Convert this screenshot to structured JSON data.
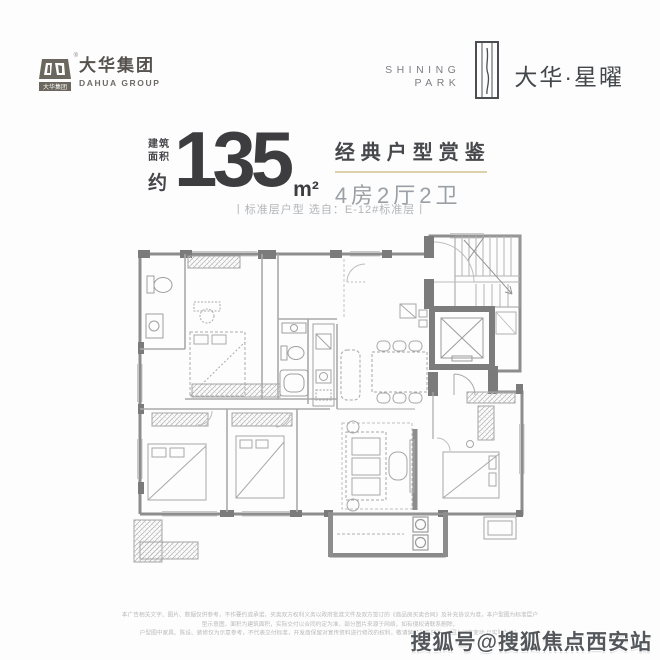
{
  "header_left": {
    "brand_cn": "大华集团",
    "brand_en": "DAHUA GROUP",
    "registered_mark": "®",
    "emblem_icon": "dahua-emblem",
    "emblem_color": "#6b675e"
  },
  "header_right": {
    "en_line1": "SHINING",
    "en_line2": "PARK",
    "tower_icon": "shining-park-tower-mark",
    "brand": "大华·星曜",
    "brand_color": "#43474b"
  },
  "title_block": {
    "area_prefix_line1": "建筑",
    "area_prefix_line2": "面积",
    "area_prefix_line3": "约",
    "area_value": "135",
    "area_unit": "m²",
    "headline": "经典户型赏鉴",
    "spec": "4房2厅2卫",
    "divider_color": "#ddd0a9",
    "caption": "丨标准层户型  选自：E-12#标准层丨"
  },
  "floorplan": {
    "type": "apartment-floor-plan-drawing",
    "features": "stair-and-elevator-core, 4 bedrooms, living-dining room with table for 6, 2 bathrooms, kitchen, balcony",
    "wall_color": "#8d8d8d",
    "line_color": "#b5b5b5"
  },
  "footer": {
    "disclaimer_line1": "本广告相关文字、图片、数据仅供参考，不作要约或承诺，买卖双方权利义务以政府批准文件及双方签订的《商品房买卖合同》及补充协议为准，本户型图为标准层户型示意图，面积为建筑面积，实际交付以合同约定为准，部分图片来源于网络，如有侵权请联系删除，",
    "disclaimer_line2": "户型图中家具、陈设、装修仅为示意参考，不代表交付标准，开发商保留对宣传资料进行修改的权利，敬请留意最新资料。（图文如有变动 以实际为准）"
  },
  "watermark": {
    "text": "搜狐号@搜狐焦点西安站"
  }
}
